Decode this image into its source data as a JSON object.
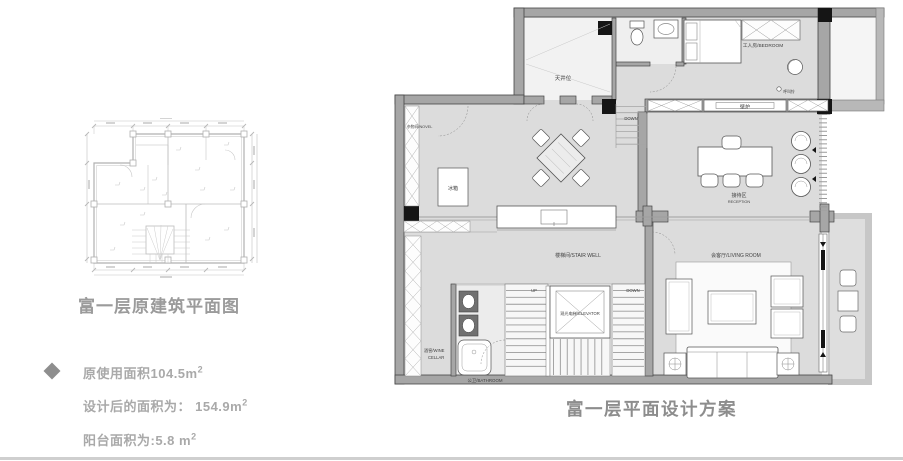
{
  "left_panel": {
    "title": "富一层原建筑平面图",
    "stats": [
      {
        "text": "原使用面积104.5m",
        "sup": "2"
      },
      {
        "text": "设计后的面积为： 154.9m",
        "sup": "2"
      },
      {
        "text": "阳台面积为:5.8 m",
        "sup": "2"
      }
    ]
  },
  "right_panel": {
    "title": "富一层平面设计方案"
  },
  "plan": {
    "labels": {
      "skylight": "天井位",
      "storage": "杂物间/NOVEL",
      "down_top": "DOWN",
      "fridge": "冰箱",
      "worker_room": "工人房/BEDROOM",
      "call_bell": "呼叫铃",
      "fireplace": "壁炉",
      "reception_cn": "接待区",
      "reception_en": "RECEPTION",
      "stair_well": "楼梯间/STAIR WELL",
      "living_room": "会客厅/LIVING ROOM",
      "up": "UP",
      "down_stairs": "DOWN",
      "elevator": "观光电梯/ELEVATOR",
      "wine_cellar_l1": "酒窖/WINE",
      "wine_cellar_l2": "CELLAR",
      "bathroom": "公卫/BATHROOM"
    }
  },
  "colors": {
    "title_gray": "#9b9b9b",
    "stat_text_gray": "#a9a9a9",
    "plan_floor_gray": "#dcdcdc",
    "wall_gray": "#a6a6a6",
    "wall_outline": "#454545",
    "column_black": "#151515",
    "sketch_line_gray": "#b4b4b4",
    "divider_gray": "#cfcfcf"
  }
}
